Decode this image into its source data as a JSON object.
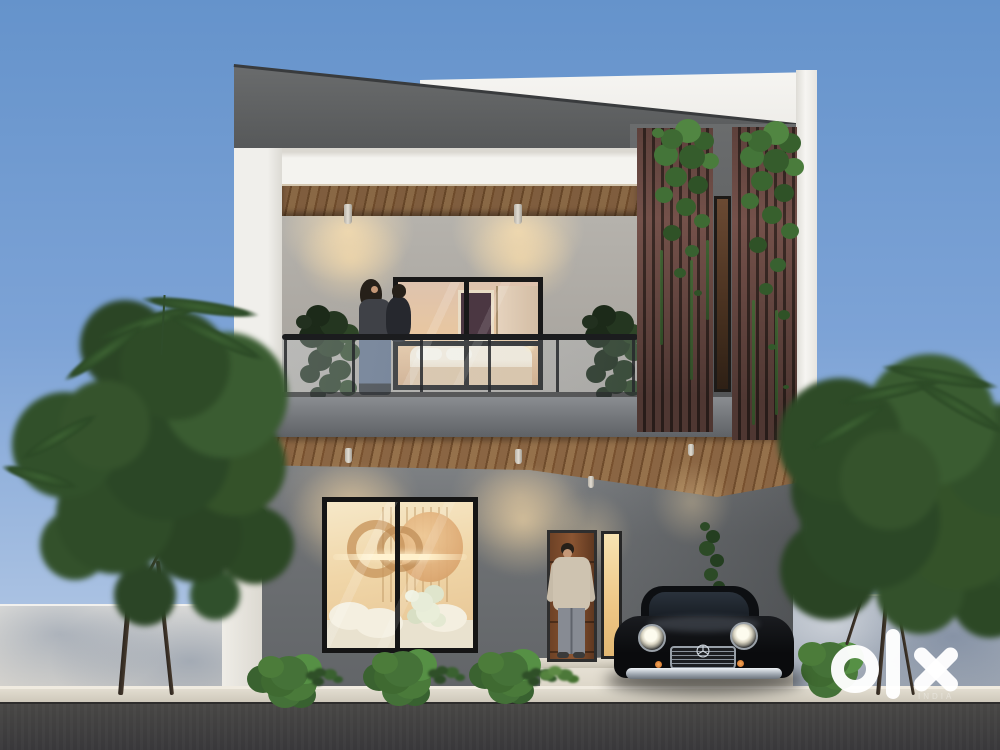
{
  "scene": {
    "description": "3D architectural render of a modern two-storey house at dusk: balcony with couple, warm-lit windows, wooden slat screens with ivy, classic black car in carport, trees and compound wall, OLX watermark",
    "watermark": {
      "brand": "olx",
      "sub_label": "INDIA"
    },
    "colors": {
      "sky_top": "#6593cb",
      "sky_bottom": "#b9cde9",
      "facade_white": "#f4f3ef",
      "parapet_gray": "#5d5f61",
      "ground_wall_gray": "#77797c",
      "wood_brown": "#8a6543",
      "slat_brown": "#74514a",
      "foliage_green": "#3c5c31",
      "window_glow": "#f0d6a8",
      "car_black": "#0d0e10",
      "road_gray": "#38373a",
      "compound_wall": "#e6e4df",
      "watermark_white": "#ffffff"
    }
  }
}
